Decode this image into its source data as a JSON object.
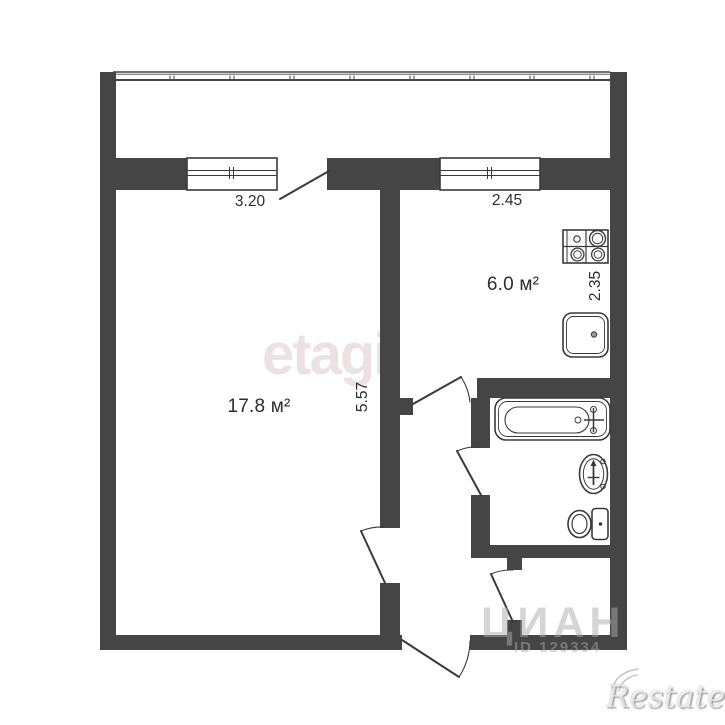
{
  "floorplan": {
    "living_room": {
      "area": "17.8 м²"
    },
    "kitchen": {
      "area": "6.0 м²"
    },
    "dimensions": {
      "living_window_width": "3.20",
      "kitchen_window_width": "2.45",
      "living_room_depth": "5.57",
      "kitchen_depth": "2.35"
    },
    "colors": {
      "wall": "#454545",
      "line": "#3a3a3a"
    }
  },
  "watermarks": {
    "etagi": {
      "text": "etagi",
      "color": "#ece2e4"
    },
    "cian": {
      "text": "ЦИАН",
      "id_text": "ID 129334"
    },
    "restate": {
      "text": "Restate"
    }
  }
}
